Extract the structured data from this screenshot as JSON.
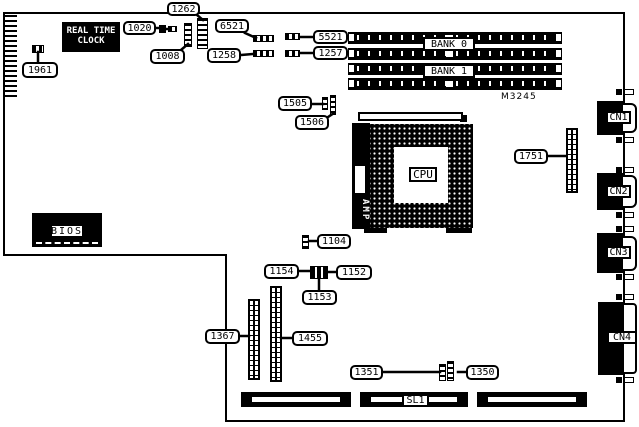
{
  "figure": {
    "type": "motherboard-layout-diagram",
    "silkscreen": "M3245",
    "ink": "#000000",
    "paper": "#ffffff"
  },
  "chips": {
    "rtc_line1": "REAL TIME",
    "rtc_line2": "CLOCK",
    "bios": "BIOS",
    "cpu": "CPU",
    "amp": "AMP"
  },
  "memory": {
    "bank0": "BANK 0",
    "bank1": "BANK 1"
  },
  "connectors": {
    "cn1": "CN1",
    "cn2": "CN2",
    "cn3": "CN3",
    "cn4": "CN4",
    "sl1": "SL1"
  },
  "callouts": {
    "1961": "1961",
    "1020": "1020",
    "1008": "1008",
    "1262": "1262",
    "6521": "6521",
    "1258": "1258",
    "5521": "5521",
    "1257": "1257",
    "1505": "1505",
    "1506": "1506",
    "1751": "1751",
    "1104": "1104",
    "1154": "1154",
    "1152": "1152",
    "1153": "1153",
    "1367": "1367",
    "1455": "1455",
    "1351": "1351",
    "1350": "1350"
  }
}
